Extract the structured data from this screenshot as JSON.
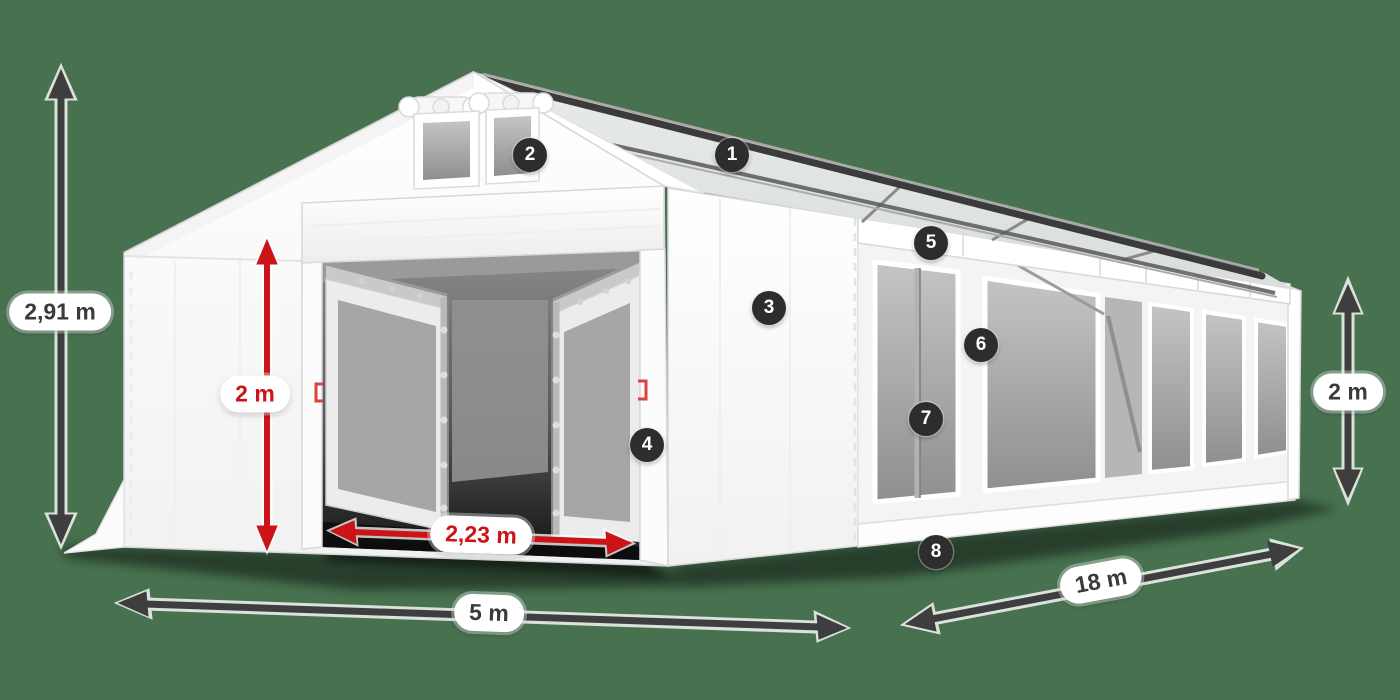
{
  "colors": {
    "c-bg": "#47714f",
    "c-arrow-dark": "#3e3e3e",
    "c-arrow-red": "#cc1318",
    "c-badge-bg": "#2d2d2d",
    "c-badge-text": "#ffffff",
    "c-label-bg": "#ffffff",
    "c-label-text": "#3a3a3a",
    "c-label-text-red": "#cc1318",
    "c-tent-white": "#ffffff",
    "c-window-grey": "#a2a2a2"
  },
  "diagram": {
    "type": "product-dimension-diagram",
    "subject": "white marquee tent illustration with dimension arrows and numbered callouts",
    "dimensions": [
      {
        "id": "ridge-height",
        "label": "2,91 m",
        "color": "dark",
        "orientation": "vertical",
        "location": "left"
      },
      {
        "id": "entrance-height",
        "label": "2 m",
        "color": "red",
        "orientation": "vertical",
        "location": "front-entrance"
      },
      {
        "id": "entrance-width",
        "label": "2,23 m",
        "color": "red",
        "orientation": "horizontal",
        "location": "front-entrance-bottom"
      },
      {
        "id": "front-width",
        "label": "5 m",
        "color": "dark",
        "orientation": "horizontal",
        "location": "front-bottom"
      },
      {
        "id": "side-length",
        "label": "18 m",
        "color": "dark",
        "orientation": "diagonal",
        "location": "right-bottom"
      },
      {
        "id": "side-height",
        "label": "2 m",
        "color": "dark",
        "orientation": "vertical",
        "location": "right"
      }
    ],
    "callouts": [
      {
        "number": "1"
      },
      {
        "number": "2"
      },
      {
        "number": "3"
      },
      {
        "number": "4"
      },
      {
        "number": "5"
      },
      {
        "number": "6"
      },
      {
        "number": "7"
      },
      {
        "number": "8"
      }
    ]
  }
}
